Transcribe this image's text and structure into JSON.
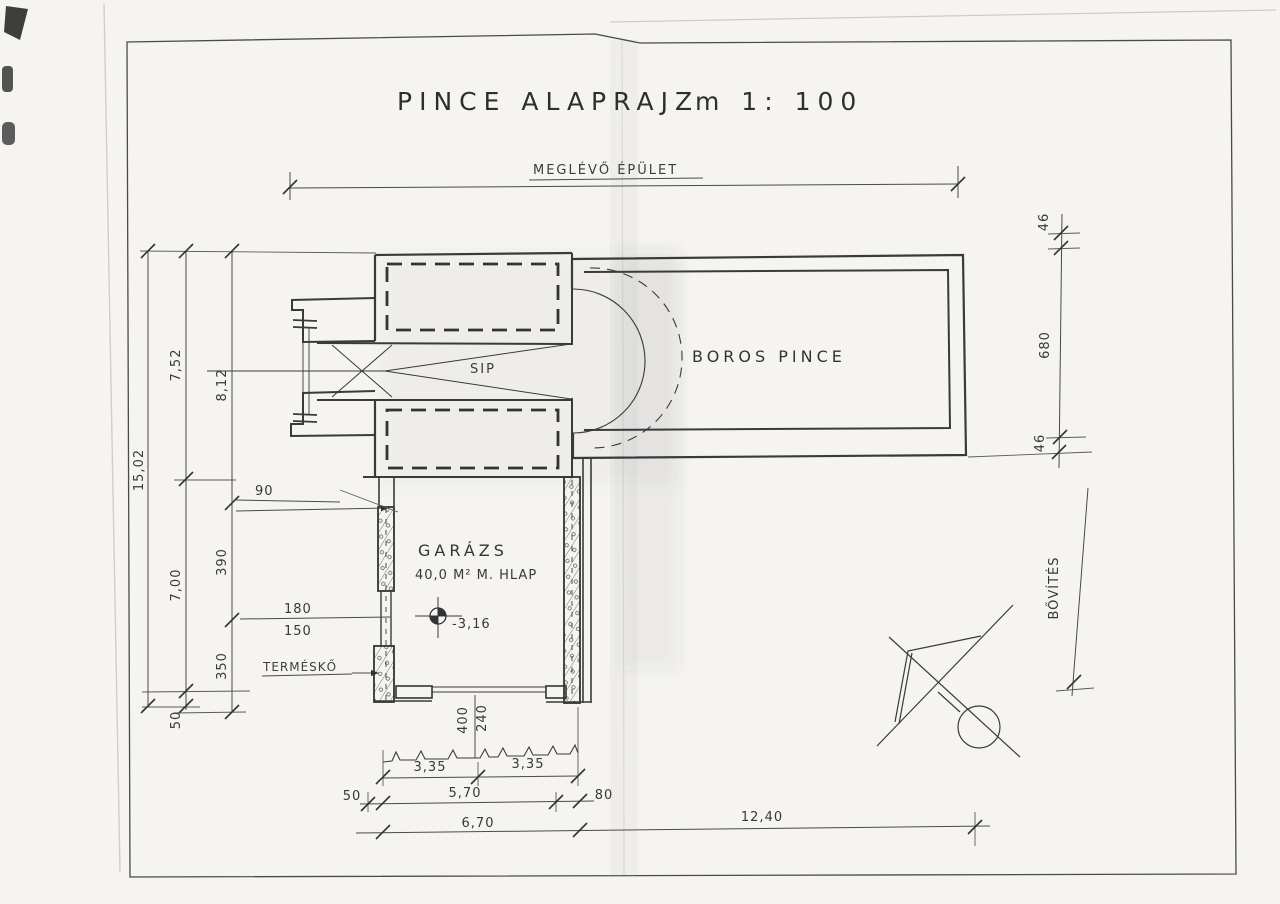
{
  "title": {
    "main": "PINCE ALAPRAJZ",
    "scale": "m 1: 100"
  },
  "labels": {
    "existing_building": "MEGLÉVŐ ÉPÜLET",
    "wine_cellar": "BOROS PINCE",
    "chute": "SIP",
    "garage": "GARÁZS",
    "garage_area": "40,0 M² M. HLAP",
    "natural_stone": "TERMÉSKŐ",
    "extension": "BŐVÍTÉS",
    "floor_level": "-3,16"
  },
  "dims": {
    "total_left": "15,02",
    "upper_left": "7,52",
    "lower_left": "7,00",
    "base_left": "50",
    "cellar_mid": "8,12",
    "seg_a": "390",
    "seg_b": "350",
    "wall_90": "90",
    "open_180": "180",
    "open_150": "150",
    "rwall_top": "46",
    "cellar_len": "680",
    "rwall_bot": "46",
    "door_w": "400",
    "door_h": "240",
    "b_335l": "3,35",
    "b_335r": "3,35",
    "b_50": "50",
    "b_570": "5,70",
    "b_80": "80",
    "b_670": "6,70",
    "b_1240": "12,40"
  }
}
